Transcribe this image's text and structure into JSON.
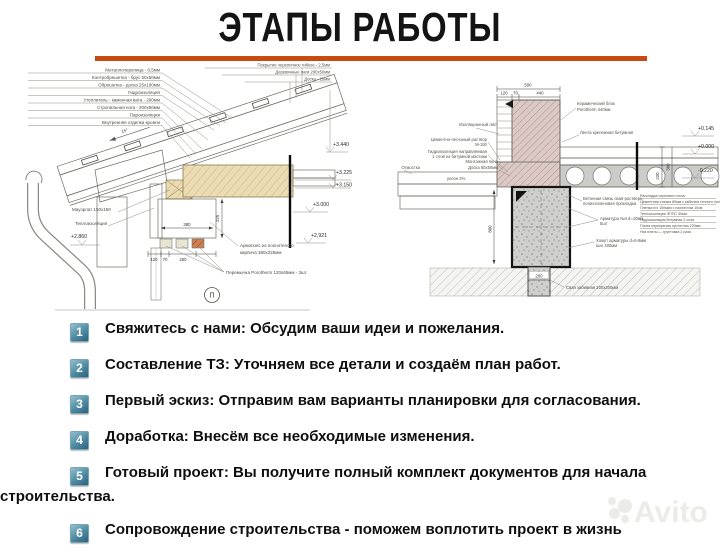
{
  "title": "ЭТАПЫ РАБОТЫ",
  "accent_color": "#c74b12",
  "badge_color": "#4e8aa2",
  "steps": [
    {
      "num": "1",
      "text": "Свяжитесь с нами: Обсудим ваши идеи и пожелания."
    },
    {
      "num": "2",
      "text": "Составление ТЗ: Уточняем все детали и создаём план работ."
    },
    {
      "num": "3",
      "text": "Первый эскиз: Отправим вам варианты планировки для согласования."
    },
    {
      "num": "4",
      "text": "Доработка: Внесём все необходимые изменения."
    },
    {
      "num": "5",
      "text": "Готовый проект: Вы получите полный комплект документов для начала строительства."
    },
    {
      "num": "6",
      "text": "Сопровождение строительства - поможем воплотить проект в жизнь"
    }
  ],
  "left_drawing": {
    "layers": [
      "Металлочерепица - 0,5мм",
      "Контробрешетка - брус 50х50мм",
      "Обрешетка - доска 25х100мм",
      "Гидроизоляция",
      "Утеплитель - каменная вата - 200мм",
      "Стропильная нога - 200х50мм",
      "Пароизоляция",
      "Внутренняя отделка кровли"
    ],
    "deck": [
      "Покрытие черепичное гибкое - 2,5мм",
      "Деревянные лаги 200х50мм",
      "Доска - 25мм"
    ],
    "angle": "15°",
    "elevations": {
      "e1": "+3.440",
      "e2": "+3.225",
      "e3": "+3.150",
      "e4": "+3.000",
      "e5": "+2,921",
      "e6": "+2.860"
    },
    "labels": {
      "mauerlat": "Мауэрлат 150х150",
      "insulation": "Теплоизоляция",
      "armo1": "Армопояс из полнотелого",
      "armo2": "кирпича 380х225мм",
      "lintel": "Перемычка Porotherm 120х65мм - 3шт.",
      "marker": "П"
    },
    "dims": {
      "d380": "380",
      "d225": "225",
      "d120": "120",
      "d70": "70",
      "d250": "250"
    }
  },
  "right_drawing": {
    "dims": {
      "d500": "500",
      "d120": "120",
      "d70": "70",
      "d440": "440",
      "d800": "800",
      "d200": "200",
      "d220": "220",
      "d360": "360"
    },
    "elevations": {
      "e1": "+0.145",
      "e2": "+0.000",
      "e3": "-0.220"
    },
    "labels": {
      "block1": "Керамический блок",
      "block2": "Porotherm 440мм",
      "tape": "Лента крепежная битумная",
      "iso": "Изоляционный лист",
      "mortar1": "Цементно-песчаный раствор",
      "mortar2": "М-150",
      "hydro1": "Гидроизоляция направляемая",
      "hydro2": "1 слой из битумной мастики",
      "foam": "Монтажная пена",
      "board": "Доска 50х50мм",
      "otmostka": "Отмостка",
      "slope": "уклон 2%",
      "tie1": "Бетонная связь свая-ростверк,",
      "tie2": "полиэтиленовая прокладка",
      "rebar1": "Арматура №4 d=10мм",
      "rebar2": "5шт",
      "stirrup1": "Хомут арматуры d=6-8мм",
      "stirrup2": "шаг 400мм",
      "pile": "Свая забивная 200х200мм"
    },
    "legend": [
      "Раскладка чернового пола:",
      "Цементная стяжка 80мм с кабелем теплого пола",
      "Пленка п/э 150мкм с нахлестом 10см",
      "Теплоизоляция ЭППС 50мм",
      "Гидроизоляция битумная 2 слоя",
      "Плита перекрытия пустотная 220мм",
      "Низ плиты — грунтовка 2 раза"
    ]
  },
  "watermark": {
    "text": "Avito"
  }
}
